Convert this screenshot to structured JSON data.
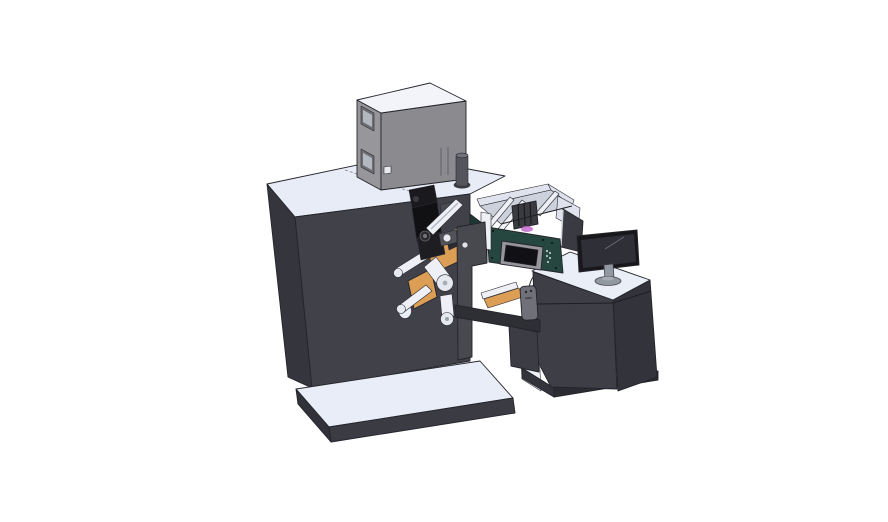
{
  "meta": {
    "description": "SolidWorks-style 3D CAD render of an industrial label printing and rewinding machine: dark cabinet body on a light base plate, gray hopper box on top, black print-head mechanism with web rollers and orange unwind plates, clear conveyor enclosure with teal HMI control panel, hanging pendant control, and an operator desk with a flat-screen monitor and side divider panel",
    "background": "#ffffff",
    "canvas": {
      "width": 888,
      "height": 522
    }
  },
  "palette": {
    "machine_front": "#41414a",
    "machine_side": "#35353e",
    "machine_top": "#e8ecf6",
    "base_top": "#e9edf7",
    "base_front": "#3b3b44",
    "base_side": "#31313a",
    "box_front": "#8a8a8f",
    "box_side": "#97979b",
    "box_top": "#f2f4f9",
    "window_frame": "#6e6e73",
    "window_glass": "#b3b7bf",
    "detail_white": "#e8eaf0",
    "cylinder_body": "#54545c",
    "cylinder_cap": "#71717a",
    "cylinder_flange": "#3f3f46",
    "conveyor_wall": "#e0e3ed",
    "conveyor_floor": "#ccd1dc",
    "conveyor_mech": "#3a3a41",
    "glow_magenta": "#c569ce",
    "green_front": "#26473f",
    "green_side": "#1c3931",
    "hmi_frame": "#95959b",
    "hmi_screen": "#111115",
    "roller_body": "#eef0f6",
    "roller_cap": "#e6e9f0",
    "orange": "#dc9d54",
    "orange_light": "#edbe85",
    "mech_black_a": "#1a1a1e",
    "mech_black_b": "#111114",
    "mech_black_c": "#1d1d22",
    "mech_gray": "#52525a",
    "plate": "#48484f",
    "beam_dark": "#2e2e35",
    "leg_dark": "#3c3c44",
    "desk_top": "#eaeef7",
    "desk_front": "#3e3e47",
    "desk_side": "#33333c",
    "desk_base": "#2b2b32",
    "desk_base_side": "#33333b",
    "interior_white": "#eef1f8",
    "divider": "#3a3a43",
    "monitor_bezel": "#18181c",
    "monitor_screen": "#2f2f37",
    "monitor_stand": "#9298a1",
    "pendant": "#707078"
  },
  "parts": {
    "base_platform": "machine base platform",
    "machine_body": "main machine cabinet",
    "hopper_box": "gray hopper box on top",
    "vent_cylinder": "exhaust cylinder",
    "conveyor": "clear conveyor enclosure",
    "green_panel": "teal HMI control housing",
    "hmi": "HMI touchscreen display",
    "mechanism": "print-head mechanism",
    "rollers": "web guide rollers",
    "unwind_plates": "orange unwind plates",
    "web_plate": "web path side plate",
    "pendant": "pendant remote control",
    "desk": "operator desk cabinet",
    "monitor": "desktop monitor",
    "divider": "desk divider panel"
  }
}
